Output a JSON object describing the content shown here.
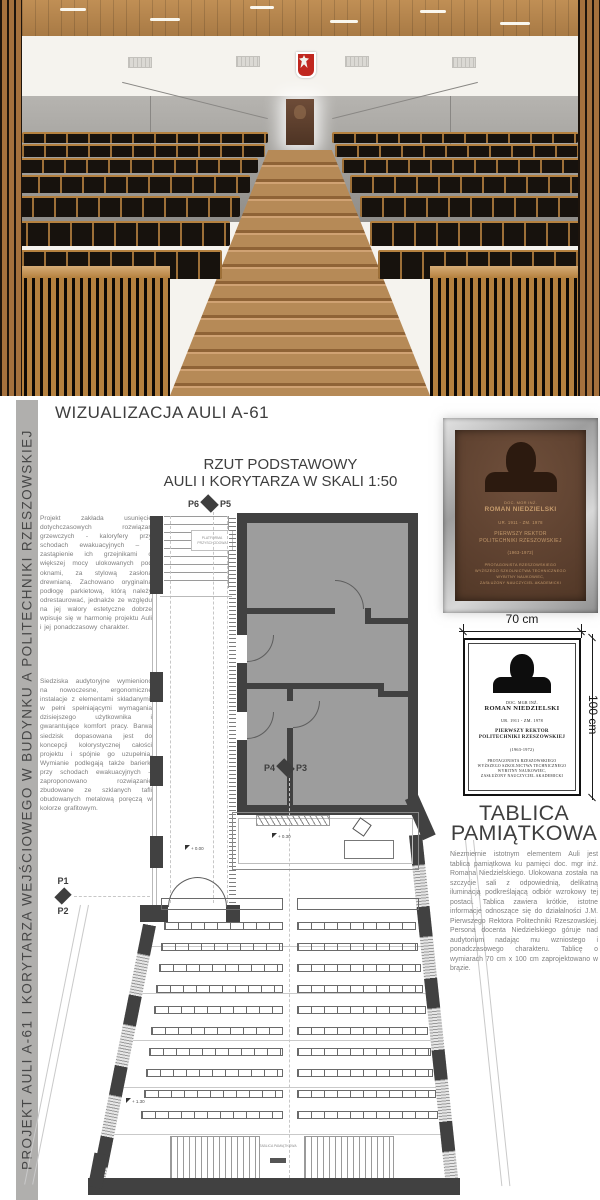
{
  "side_label": "PROJEKT AULI A-61 I KORYTARZA WEJŚCIOWEGO W BUDYNKU A POLITECHNIKI RZESZOWSKIEJ",
  "visualization": {
    "title": "WIZUALIZACJA AULI A-61"
  },
  "plan": {
    "title_line1": "RZUT PODSTAWOWY",
    "title_line2": "AULI I KORYTARZA W SKALI 1:50",
    "paragraph1": "Projekt zakłada usunięcie dotychczasowych rozwiązań grzewczych - kaloryfery przy schodach ewakuacyjnych – i zastąpienie ich grzejnikami o większej mocy ulokowanych pod oknami, za stylową zasłoną drewnianą. Zachowano oryginalną podłogę parkietową, którą należy odrestaurować, jednakże ze względu na jej walory estetyczne dobrze wpisuje się w harmonię projektu Auli i jej ponadczasowy charakter.",
    "paragraph2": "Siedziska audytoryjne wymieniono na nowoczesne, ergonomiczne instalacje z elementami składanymi, w pełni spełniającymi wymagania dzisiejszego użytkownika i gwarantujące komfort pracy. Barwa siedzisk dopasowana jest do koncepcji kolorystycznej całości projektu i spójnie go uzupełnia. Wymianie podlegają także barierki przy schodach ewakuacyjnych – zaproponowano rozwiązanie zbudowane ze szklanych tafli obudowanych metalową poręczą w kolorze grafitowym.",
    "markers": {
      "p1": "P1",
      "p2": "P2",
      "p3": "P3",
      "p4": "P4",
      "p5": "P5",
      "p6": "P6"
    },
    "stair_platform_label": "PLATFORMA PRZYSCHODOWA",
    "plaque_location_label": "TABLICA PAMIĄTKOWA",
    "elevation_zero": "+ 0.00",
    "elevation_stage": "+ 0.30",
    "elevation_back": "+ 1.30"
  },
  "plaque": {
    "prefix": "DOC. MGR INŻ.",
    "name": "ROMAN NIEDZIELSKI",
    "dates": "UR. 1911 - ZM. 1978",
    "role_line1": "PIERWSZY REKTOR",
    "role_line2": "POLITECHNIKI RZESZOWSKIEJ",
    "tenure": "(1963-1972)",
    "desc_line1": "PROTAGONISTA RZESZOWSKIEGO",
    "desc_line2": "WYŻSZEGO SZKOLNICTWA TECHNICZNEGO",
    "desc_line3": "WYBITNY NAUKOWIEC,",
    "desc_line4": "ZASŁUŻONY NAUCZYCIEL AKADEMICKI",
    "width_dim": "70 cm",
    "height_dim": "100 cm"
  },
  "memorial": {
    "title_line1": "TABLICA",
    "title_line2": "PAMIĄTKOWA",
    "paragraph": "Niezmiernie istotnym elementem Auli jest tablica pamiątkowa ku pamięci doc. mgr inż. Romana Niedzielskiego. Ulokowana została na szczycie sali z odpowiednią, delikatną iluminacją podkreślającą odbiór wzrokowy tej postaci. Tablica zawiera krótkie, istotne informacje odnoszące się do działalności J.M. Pierwszego Rektora Politechniki Rzeszowskiej. Persona docenta Niedzielskiego góruje nad audytorium nadając mu wzniostego i ponadczasowego charakteru. Tablicę o wymiarach 70 cm x 100 cm zaprojektowano w brązie."
  }
}
